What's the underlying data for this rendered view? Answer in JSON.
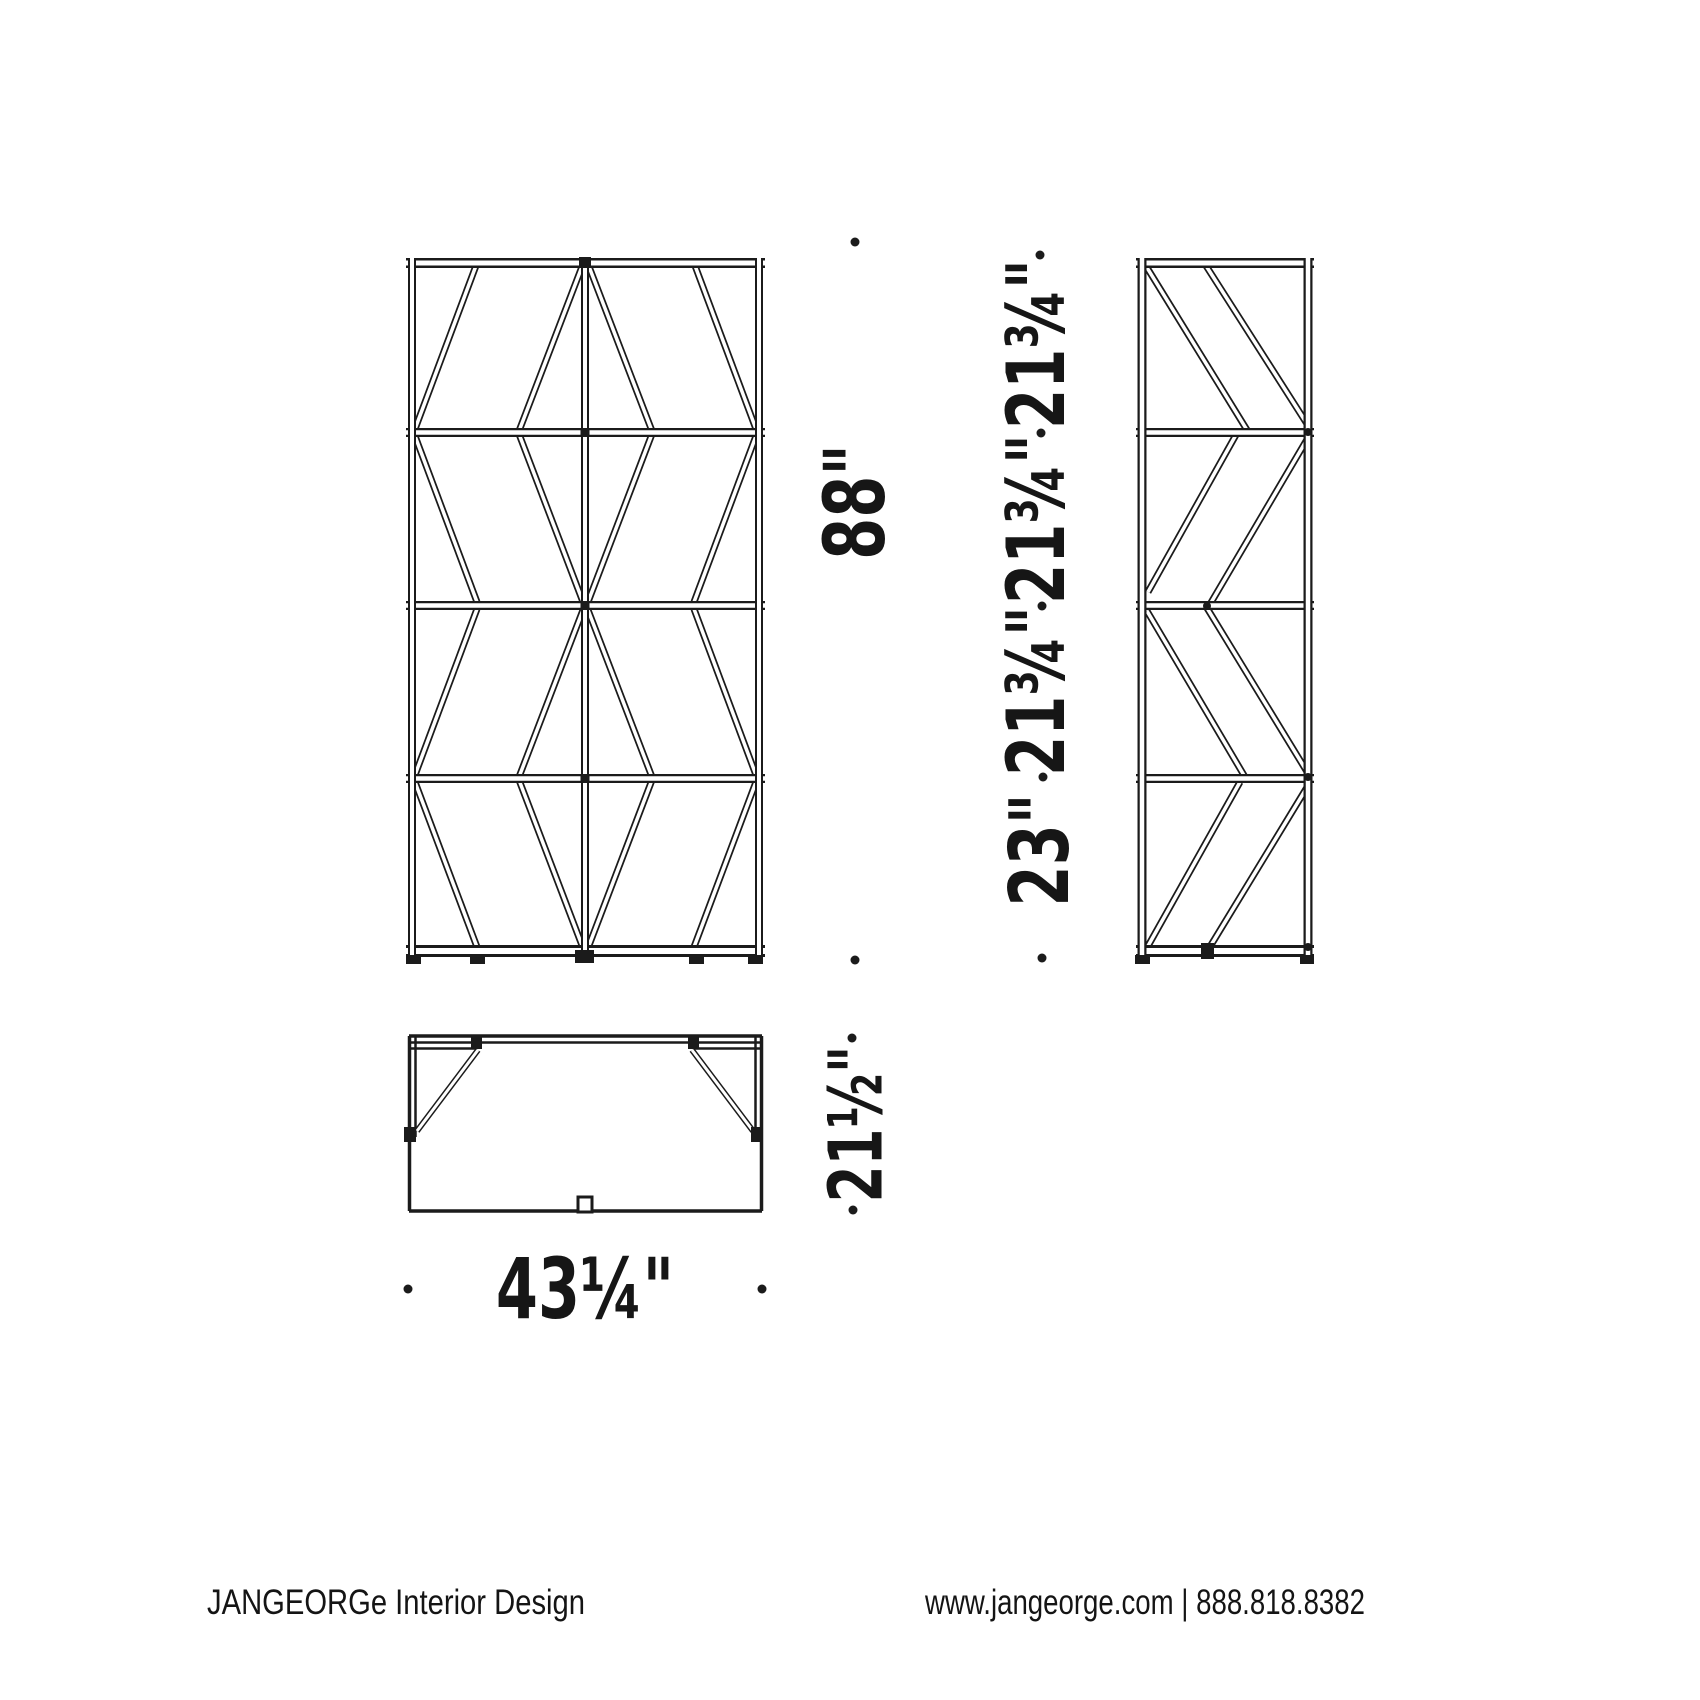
{
  "drawing": {
    "ink": "#1b1b1b",
    "background": "#ffffff",
    "subject": "shelving-unit-three-view-technical-drawing"
  },
  "dimensions": {
    "front_height": "88\"",
    "front_width": "43¼\"",
    "top_depth": "21½\"",
    "side_row_bottom": "23\"",
    "side_row_2": "21¾\"",
    "side_row_3": "21¾\"",
    "side_row_4": "21¾\""
  },
  "footer": {
    "left": "JANGEORGe Interior Design",
    "right": "www.jangeorge.com | 888.818.8382"
  }
}
